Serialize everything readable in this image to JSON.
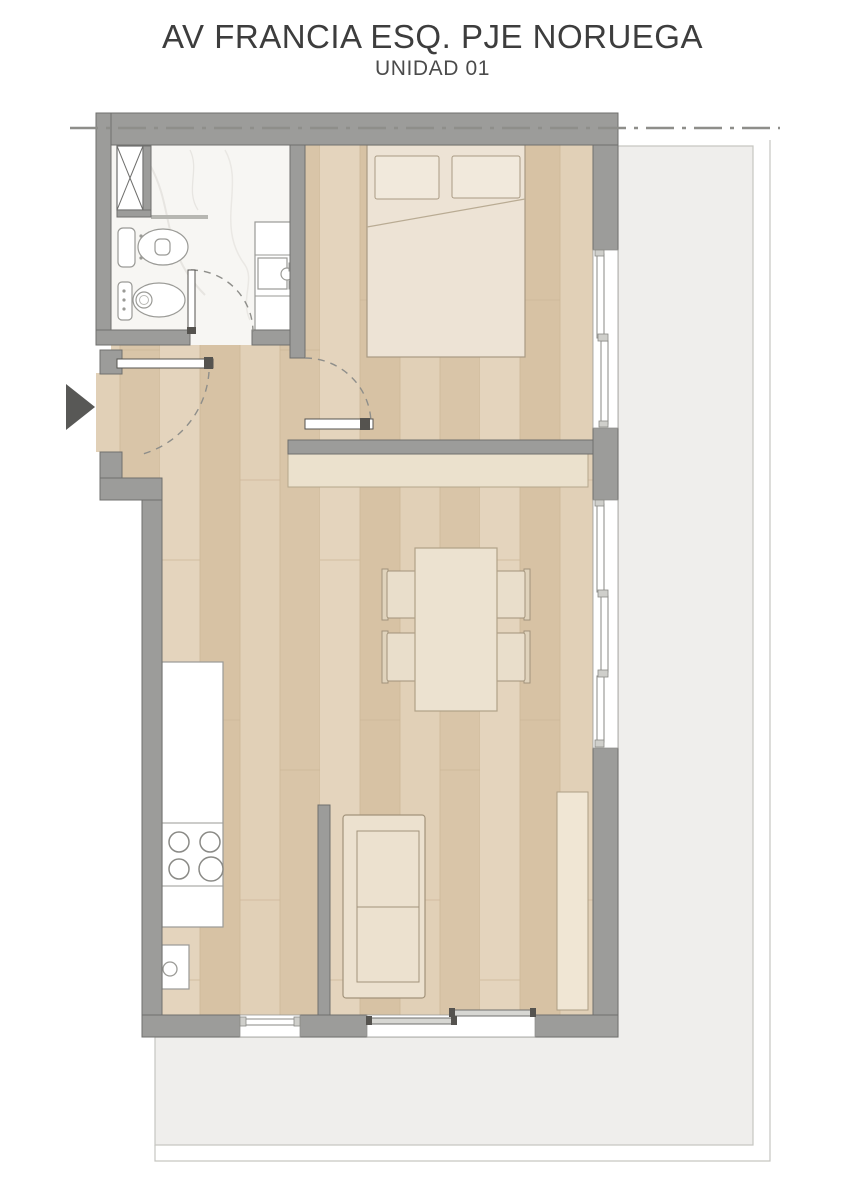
{
  "header": {
    "title": "AV FRANCIA ESQ. PJE NORUEGA",
    "subtitle": "UNIDAD 01"
  },
  "plan": {
    "colors": {
      "wall": "#9c9c9a",
      "wall_outline": "#6f6f6d",
      "wood_floor": "#ddc9ac",
      "bathroom_floor": "#f7f6f3",
      "terrace": "#efeeec",
      "terrace_outline": "#c6c6c1",
      "furniture_fill": "#ece2d0",
      "furniture_outline": "#a2937b",
      "fixture_outline": "#9a9a96",
      "entry_arrow": "#585856",
      "boundary_line": "#8e8e8a",
      "title_text": "#3d3d3d"
    },
    "elements": [
      "boundary-dashdot-line",
      "entry-arrow",
      "entry-door",
      "shaft-duct",
      "bathroom-floor",
      "toilet",
      "bidet",
      "vanity-sink",
      "bathroom-door",
      "bedroom-floor",
      "double-bed",
      "pillows",
      "bedroom-window",
      "bedroom-door",
      "sideboard-shelf",
      "dining-table",
      "dining-chairs",
      "kitchen-counter",
      "cooktop-burners",
      "kitchen-sink",
      "kitchen-window",
      "partition-wall",
      "sofa",
      "tall-cabinet",
      "living-room-windows",
      "sliding-terrace-door",
      "terrace"
    ]
  }
}
